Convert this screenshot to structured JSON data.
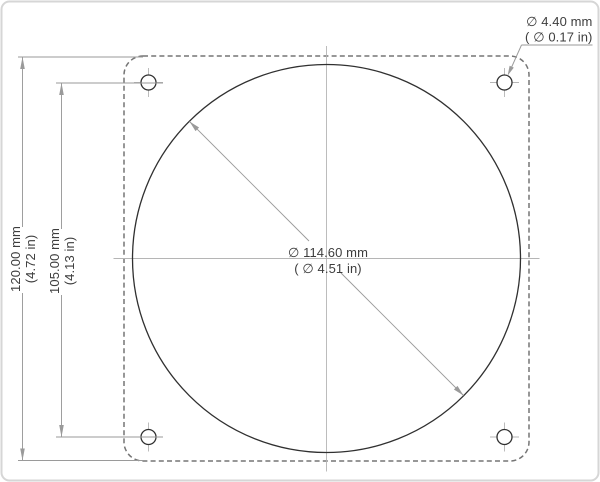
{
  "dimensions": {
    "overall_height": {
      "mm": "120.00 mm",
      "in": "(4.72 in)"
    },
    "hole_spacing": {
      "mm": "105.00 mm",
      "in": "(4.13 in)"
    },
    "bore_diameter": {
      "mm": "∅ 114.60 mm",
      "in": "( ∅ 4.51 in)"
    },
    "hole_diameter": {
      "mm": "∅ 4.40 mm",
      "in": "( ∅ 0.17 in)"
    }
  },
  "colors": {
    "frame": "#d6d6d6",
    "outline_dashed": "#757575",
    "solid_edge": "#303030",
    "centerline": "#b5b5b5",
    "dimension": "#9a9a9a",
    "text": "#3d3d3d"
  }
}
